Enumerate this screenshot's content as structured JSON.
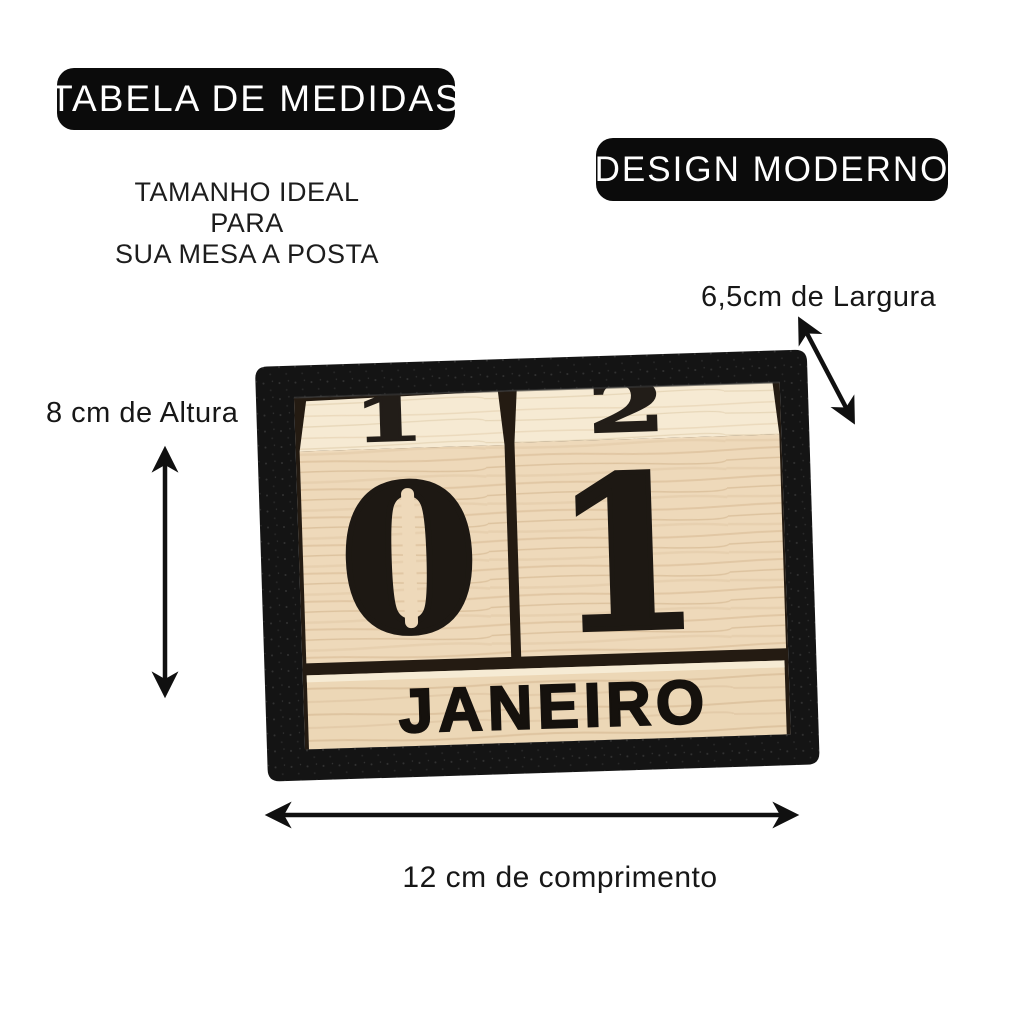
{
  "badges": {
    "size_table": "TABELA DE MEDIDAS",
    "modern_design": "DESIGN MODERNO"
  },
  "subtitle": {
    "line1": "TAMANHO IDEAL PARA",
    "line2": "SUA MESA A POSTA"
  },
  "dimensions": {
    "width": "6,5cm de Largura",
    "height": "8 cm de Altura",
    "length": "12 cm de comprimento"
  },
  "calendar": {
    "top_left_digit": "1",
    "top_right_digit": "2",
    "front_left_digit": "0",
    "front_right_digit": "1",
    "month": "JANEIRO"
  },
  "colors": {
    "background": "#ffffff",
    "badge_bg": "#0b0b0b",
    "badge_text": "#ffffff",
    "label_text": "#171717",
    "arrow": "#101010",
    "frame_black": "#141414",
    "wood_front": "#eed9ba",
    "wood_top": "#f6ead3",
    "wood_month_bar": "#ecd7b6",
    "engraved_digit": "#1d1813"
  }
}
